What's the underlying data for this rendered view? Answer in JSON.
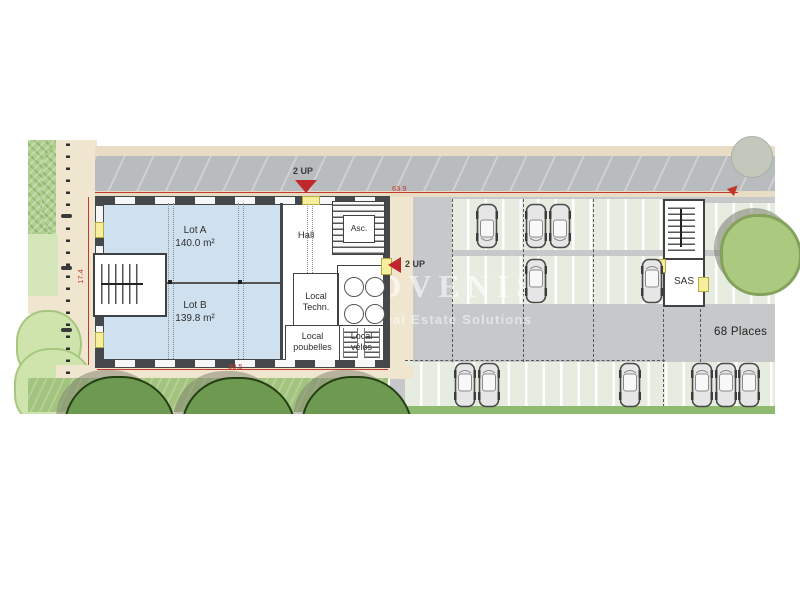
{
  "watermark": {
    "brand": "ADVENIS",
    "tagline": "Real Estate Solutions"
  },
  "dimensions": {
    "width_total": "63.9",
    "depth_left": "17.4",
    "width_building": "30.5"
  },
  "markers": {
    "up_top": "2 UP",
    "up_side": "2 UP"
  },
  "parking": {
    "capacity_label": "68 Places"
  },
  "building": {
    "lot_a_name": "Lot A",
    "lot_a_area": "140.0 m²",
    "lot_b_name": "Lot B",
    "lot_b_area": "139.8 m²",
    "hall": "Hall",
    "elevator": "Asc.",
    "tech_line1": "Local",
    "tech_line2": "Techn.",
    "bins_line1": "Local",
    "bins_line2": "poubelles",
    "bikes_line1": "Local",
    "bikes_line2": "vélos",
    "sas": "SAS"
  },
  "colors": {
    "dimension_red": "#c0392b",
    "lot_fill": "#cfe1ef",
    "parking_gray": "#c6c8ca",
    "door_yellow": "#f5ef9e"
  },
  "site": {
    "cars": [
      {
        "x": 487,
        "y": 226,
        "dir": "down"
      },
      {
        "x": 536,
        "y": 226,
        "dir": "down"
      },
      {
        "x": 560,
        "y": 226,
        "dir": "down"
      },
      {
        "x": 536,
        "y": 281,
        "dir": "up"
      },
      {
        "x": 652,
        "y": 281,
        "dir": "up"
      },
      {
        "x": 465,
        "y": 385,
        "dir": "up"
      },
      {
        "x": 489,
        "y": 385,
        "dir": "up"
      },
      {
        "x": 630,
        "y": 385,
        "dir": "up"
      },
      {
        "x": 702,
        "y": 385,
        "dir": "up"
      },
      {
        "x": 726,
        "y": 385,
        "dir": "up"
      },
      {
        "x": 749,
        "y": 385,
        "dir": "up"
      }
    ]
  }
}
